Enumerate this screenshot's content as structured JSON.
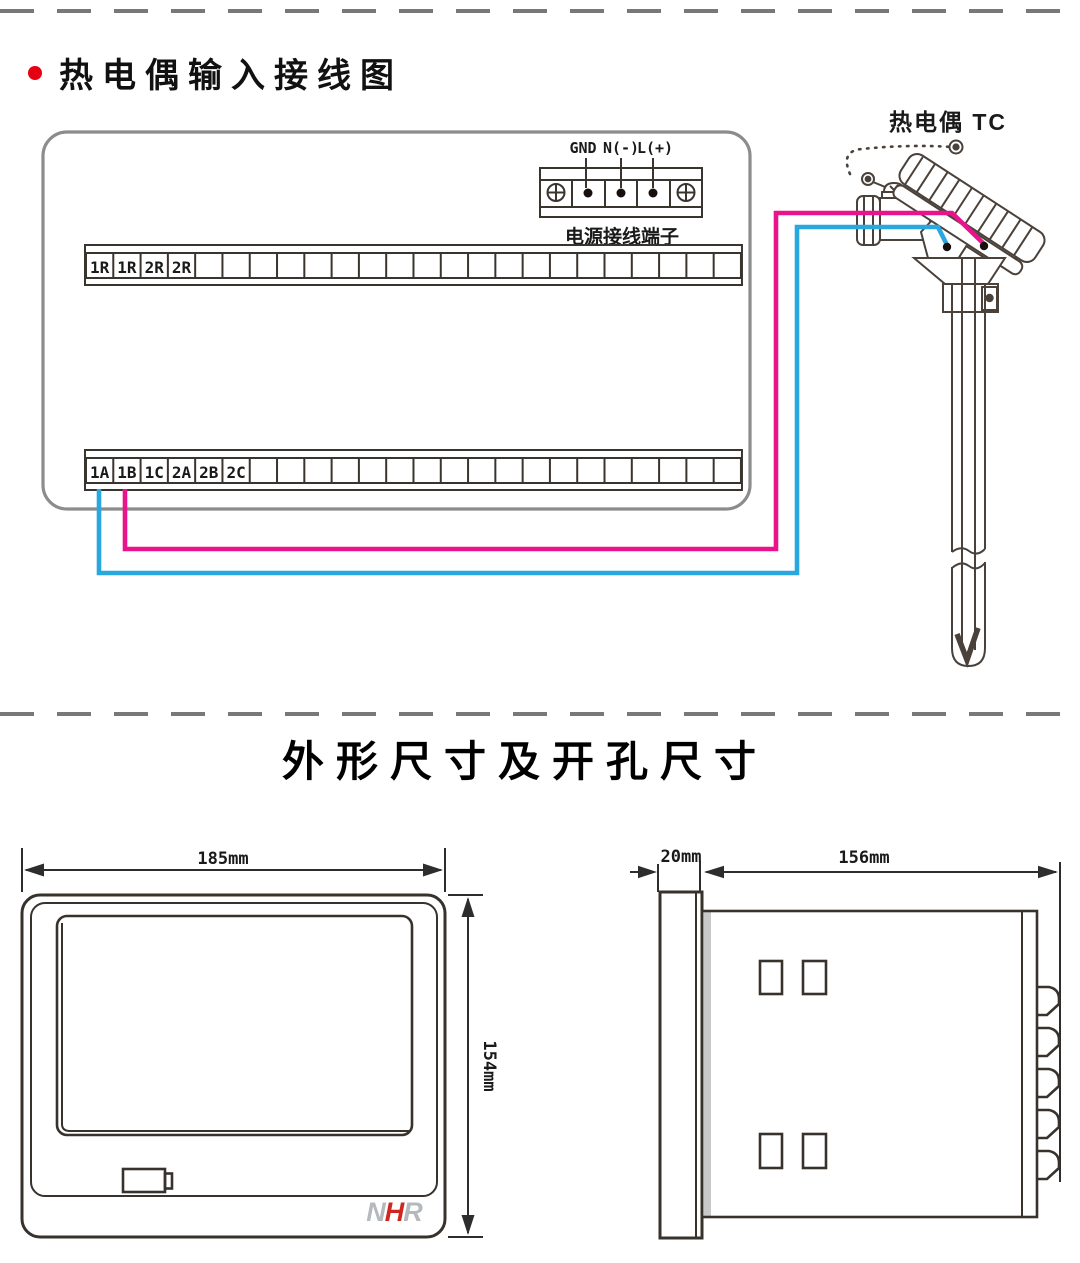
{
  "wiring": {
    "section_title": "热电偶输入接线图",
    "bullet_color": "#e60012",
    "power_terminal": {
      "labels": [
        "GND",
        "N(-)",
        "L(+)"
      ],
      "caption": "电源接线端子"
    },
    "strips": {
      "cell_count": 24,
      "top": {
        "labels": [
          "1R",
          "1R",
          "2R",
          "2R"
        ]
      },
      "bottom": {
        "labels": [
          "1A",
          "1B",
          "1C",
          "2A",
          "2B",
          "2C"
        ]
      }
    },
    "thermocouple": {
      "label": "热电偶 TC"
    },
    "wires": {
      "positive_color": "#e8148c",
      "negative_color": "#29a8e0",
      "positive_terminal": "1B",
      "negative_terminal": "1A"
    }
  },
  "dimensions": {
    "section_title": "外形尺寸及开孔尺寸",
    "front_view": {
      "width_label": "185mm",
      "height_label": "154mm",
      "logo": {
        "n": "N",
        "h": "H",
        "r": "R",
        "h_color": "#cd2720",
        "nr_color": "#b5b9bd"
      }
    },
    "side_view": {
      "bezel_label": "20mm",
      "depth_label": "156mm"
    }
  }
}
